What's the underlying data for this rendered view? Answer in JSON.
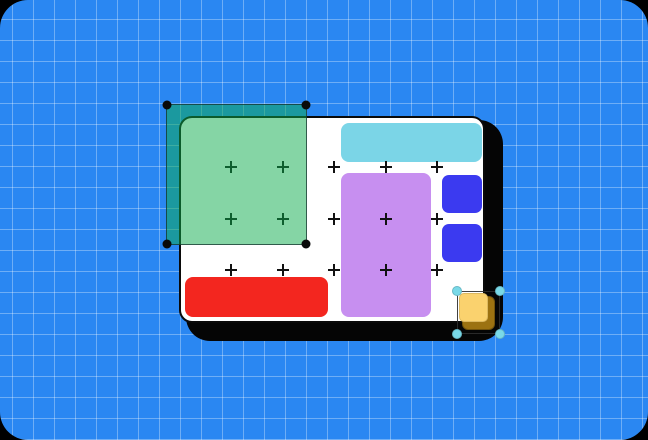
{
  "scene": {
    "description": "design-tool canvas illustration",
    "artboard": "white card with hard black offset shadow",
    "selection_green": "translucent green rectangle selected with 4 black corner handles",
    "selection_yellow": "small yellow square with brown offset shadow selected with 4 cyan corner handles"
  },
  "palette": {
    "backdrop": "#000000",
    "canvas_blue": "#2A87F2",
    "grid_line": "rgba(255,255,255,0.32)",
    "shadow_black": "#050505",
    "artboard_white": "#FFFFFF",
    "cyan_bar": "#7BD5E7",
    "purple_rect": "#C78FF0",
    "blue_square": "#3B3AF0",
    "red_bar": "#F3261F",
    "green_fill": "rgba(12,172,76,0.5)",
    "black_handle": "#0A0A0A",
    "yellow_square": "#FAD26E",
    "brown_square": "#9C7211",
    "cyan_handle": "#79D9E8"
  },
  "plus_grid": {
    "xs": [
      50,
      102,
      153,
      205,
      256
    ],
    "ys": [
      49,
      101,
      152
    ]
  }
}
